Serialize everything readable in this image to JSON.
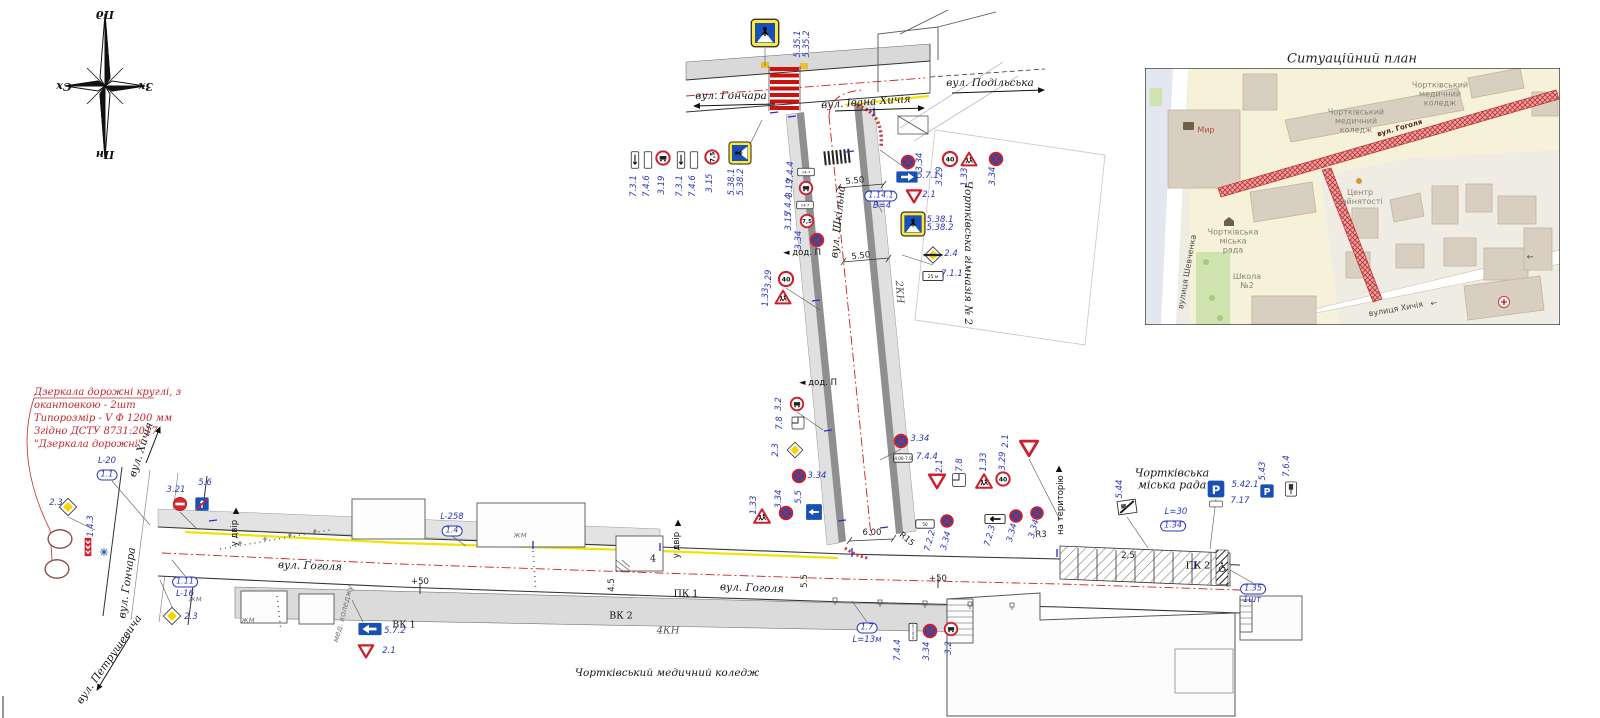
{
  "compass": {
    "top": "Пд",
    "left": "Сх",
    "right": "Зх",
    "bottom": "Пн"
  },
  "note": {
    "lines": [
      "Дзеркала дорожні круглі, з",
      "окантовкою - 2шт",
      "Типорозмір - V  Ф 1200 мм",
      "Згідно ДСТУ 8731:2017",
      "\"Дзеркала дорожні\""
    ]
  },
  "inset": {
    "title": "Ситуаційний план"
  },
  "annotations": [
    {
      "t": "Пд",
      "x": 105,
      "y": 14,
      "c": "cmp",
      "r": 180,
      "n": "compass-label-south"
    },
    {
      "t": "Сх",
      "x": 64,
      "y": 86,
      "c": "cmp",
      "r": 180,
      "n": "compass-label-east"
    },
    {
      "t": "Зх",
      "x": 146,
      "y": 86,
      "c": "cmp",
      "r": 180,
      "n": "compass-label-west"
    },
    {
      "t": "Пн",
      "x": 105,
      "y": 154,
      "c": "cmp",
      "r": 180,
      "n": "compass-label-north"
    },
    {
      "t": "вул. Гончара",
      "x": 731,
      "y": 97,
      "c": "st",
      "n": "street-honchara"
    },
    {
      "t": "вул. Івана Хичія",
      "x": 866,
      "y": 103,
      "c": "st",
      "r": -4,
      "n": "street-ivana-khychiia"
    },
    {
      "t": "вул. Подільська",
      "x": 990,
      "y": 84,
      "c": "st",
      "n": "street-podilska"
    },
    {
      "t": "вул. Шкільна",
      "x": 839,
      "y": 222,
      "c": "st",
      "r": -84,
      "n": "street-shkilna"
    },
    {
      "t": "вул. Гоголя",
      "x": 310,
      "y": 567,
      "c": "st",
      "r": 2,
      "n": "street-hoholia"
    },
    {
      "t": "вул. Гоголя",
      "x": 752,
      "y": 589,
      "c": "st",
      "r": 2,
      "n": "street-hoholia"
    },
    {
      "t": "вул. Гончара",
      "x": 128,
      "y": 583,
      "c": "st",
      "r": -82,
      "n": "street-honchara"
    },
    {
      "t": "вул. Хичія",
      "x": 142,
      "y": 450,
      "c": "st",
      "r": -72,
      "n": "street-khychiia"
    },
    {
      "t": "вул. Петрушевича",
      "x": 110,
      "y": 660,
      "c": "st",
      "r": -55,
      "n": "street-petrushevycha"
    },
    {
      "t": "Чортківська гімназія № 2",
      "x": 967,
      "y": 253,
      "c": "st",
      "r": 90,
      "n": "gymnasium-label"
    },
    {
      "t": "Чортківська\nміська рада",
      "x": 1172,
      "y": 480,
      "c": "stc",
      "n": "city-council-label"
    },
    {
      "t": "Чортківський медичний коледж",
      "x": 667,
      "y": 674,
      "c": "st",
      "n": "medical-college-label"
    },
    {
      "t": "2КН",
      "x": 899,
      "y": 292,
      "c": "stg",
      "r": 86
    },
    {
      "t": "4КН",
      "x": 668,
      "y": 631,
      "c": "stg"
    },
    {
      "t": "ВК 1",
      "x": 404,
      "y": 626,
      "c": "bk2"
    },
    {
      "t": "ВК 2",
      "x": 621,
      "y": 617,
      "c": "bk2"
    },
    {
      "t": "ПК 1",
      "x": 686,
      "y": 595,
      "c": "bk2"
    },
    {
      "t": "ПК 2",
      "x": 1198,
      "y": 567,
      "c": "bk2"
    },
    {
      "t": "+50",
      "x": 420,
      "y": 583,
      "c": "dim"
    },
    {
      "t": "+50",
      "x": 938,
      "y": 580,
      "c": "dim"
    },
    {
      "t": "6.00",
      "x": 872,
      "y": 534,
      "c": "dim"
    },
    {
      "t": "5.50",
      "x": 855,
      "y": 182,
      "c": "dim",
      "r": -6
    },
    {
      "t": "5.50",
      "x": 861,
      "y": 257,
      "c": "dim",
      "r": -6
    },
    {
      "t": "R15",
      "x": 906,
      "y": 540,
      "c": "dim",
      "r": 40
    },
    {
      "t": "R3",
      "x": 1041,
      "y": 536,
      "c": "dim"
    },
    {
      "t": "4",
      "x": 653,
      "y": 560,
      "c": "bk2"
    },
    {
      "t": "2,5",
      "x": 1128,
      "y": 557,
      "c": "dim"
    },
    {
      "t": "4.5",
      "x": 613,
      "y": 585,
      "c": "dim",
      "r": -90
    },
    {
      "t": "5.5",
      "x": 806,
      "y": 581,
      "c": "dim",
      "r": -90
    },
    {
      "t": "◄ дод. П",
      "x": 802,
      "y": 254,
      "c": "bk"
    },
    {
      "t": "◄ дод. П",
      "x": 818,
      "y": 384,
      "c": "bk"
    },
    {
      "t": "у двір",
      "x": 678,
      "y": 545,
      "c": "bk",
      "r": -90
    },
    {
      "t": "▲",
      "x": 678,
      "y": 524,
      "c": "bk"
    },
    {
      "t": "у двір",
      "x": 236,
      "y": 533,
      "c": "bk",
      "r": -90
    },
    {
      "t": "▲",
      "x": 236,
      "y": 512,
      "c": "bk"
    },
    {
      "t": "на територію",
      "x": 1062,
      "y": 505,
      "c": "bk",
      "r": -90
    },
    {
      "t": "▲",
      "x": 1059,
      "y": 470,
      "c": "bk"
    },
    {
      "t": "мед. коледжу",
      "x": 344,
      "y": 614,
      "c": "bkg",
      "r": -75
    },
    {
      "t": "жм",
      "x": 195,
      "y": 600,
      "c": "bkg"
    },
    {
      "t": "жм",
      "x": 248,
      "y": 621,
      "c": "bkg"
    },
    {
      "t": "жм",
      "x": 520,
      "y": 536,
      "c": "bkg"
    },
    {
      "t": "5.35.1",
      "x": 799,
      "y": 44,
      "c": "bl",
      "r": -90
    },
    {
      "t": "5.35.2",
      "x": 808,
      "y": 44,
      "c": "bl",
      "r": -90
    },
    {
      "t": "7.3.1",
      "x": 635,
      "y": 186,
      "c": "bl",
      "r": -90
    },
    {
      "t": "7.4.6",
      "x": 648,
      "y": 186,
      "c": "bl",
      "r": -90
    },
    {
      "t": "3.19",
      "x": 663,
      "y": 185,
      "c": "bl",
      "r": -90
    },
    {
      "t": "7.3.1",
      "x": 681,
      "y": 186,
      "c": "bl",
      "r": -90
    },
    {
      "t": "7.4.6",
      "x": 694,
      "y": 186,
      "c": "bl",
      "r": -90
    },
    {
      "t": "3.15",
      "x": 711,
      "y": 183,
      "c": "bl",
      "r": -90
    },
    {
      "t": "5.38.1",
      "x": 733,
      "y": 182,
      "c": "bl",
      "r": -90
    },
    {
      "t": "5.38.2",
      "x": 742,
      "y": 182,
      "c": "bl",
      "r": -90
    },
    {
      "t": "3.34",
      "x": 921,
      "y": 162,
      "c": "bl",
      "r": -90
    },
    {
      "t": "5.7.1",
      "x": 928,
      "y": 177,
      "c": "bl"
    },
    {
      "t": "2.1",
      "x": 929,
      "y": 196,
      "c": "bl"
    },
    {
      "t": "5.38.1",
      "x": 940,
      "y": 221,
      "c": "bl"
    },
    {
      "t": "5.38.2",
      "x": 940,
      "y": 229,
      "c": "bl"
    },
    {
      "t": "2.4",
      "x": 951,
      "y": 255,
      "c": "bl"
    },
    {
      "t": "7.1.1",
      "x": 952,
      "y": 275,
      "c": "bl"
    },
    {
      "t": "3.29",
      "x": 941,
      "y": 176,
      "c": "bl",
      "r": -90
    },
    {
      "t": "1.33",
      "x": 966,
      "y": 177,
      "c": "bl",
      "r": -90
    },
    {
      "t": "3.34",
      "x": 994,
      "y": 176,
      "c": "bl",
      "r": -90
    },
    {
      "t": "1.14.1",
      "x": 881,
      "y": 196,
      "c": "bx",
      "n": "marking-label"
    },
    {
      "t": "В=4",
      "x": 882,
      "y": 207,
      "c": "bl"
    },
    {
      "t": "7.4.4",
      "x": 792,
      "y": 172,
      "c": "bl",
      "r": -90
    },
    {
      "t": "3.19",
      "x": 791,
      "y": 188,
      "c": "bl",
      "r": -90
    },
    {
      "t": "7.4.4",
      "x": 790,
      "y": 205,
      "c": "bl",
      "r": -90
    },
    {
      "t": "3.15",
      "x": 790,
      "y": 221,
      "c": "bl",
      "r": -90
    },
    {
      "t": "3.34",
      "x": 800,
      "y": 240,
      "c": "bl",
      "r": -90
    },
    {
      "t": "3.29",
      "x": 770,
      "y": 279,
      "c": "bl",
      "r": -90
    },
    {
      "t": "1.33",
      "x": 767,
      "y": 297,
      "c": "bl",
      "r": -90
    },
    {
      "t": "3.2",
      "x": 780,
      "y": 404,
      "c": "bl",
      "r": -90
    },
    {
      "t": "7.8",
      "x": 781,
      "y": 423,
      "c": "bl",
      "r": -90
    },
    {
      "t": "2.3",
      "x": 777,
      "y": 450,
      "c": "bl",
      "r": -90
    },
    {
      "t": "3.34",
      "x": 817,
      "y": 477,
      "c": "bl"
    },
    {
      "t": "5.5",
      "x": 800,
      "y": 497,
      "c": "bl",
      "r": -90
    },
    {
      "t": "1.33",
      "x": 755,
      "y": 505,
      "c": "bl",
      "r": -90
    },
    {
      "t": "3.34",
      "x": 780,
      "y": 499,
      "c": "bl",
      "r": -90
    },
    {
      "t": "3.34",
      "x": 920,
      "y": 440,
      "c": "bl"
    },
    {
      "t": "7.4.4",
      "x": 927,
      "y": 458,
      "c": "bl"
    },
    {
      "t": "2.1",
      "x": 941,
      "y": 466,
      "c": "bl",
      "r": -90
    },
    {
      "t": "7.8",
      "x": 961,
      "y": 465,
      "c": "bl",
      "r": -90
    },
    {
      "t": "1.33",
      "x": 985,
      "y": 462,
      "c": "bl",
      "r": -90
    },
    {
      "t": "3.29",
      "x": 1004,
      "y": 461,
      "c": "bl",
      "r": -90
    },
    {
      "t": "2.1",
      "x": 1007,
      "y": 441,
      "c": "bl",
      "r": -90
    },
    {
      "t": "7.2.2",
      "x": 931,
      "y": 541,
      "c": "bl",
      "r": -75
    },
    {
      "t": "3.34",
      "x": 947,
      "y": 541,
      "c": "bl",
      "r": -75
    },
    {
      "t": "7.2.3",
      "x": 991,
      "y": 536,
      "c": "bl",
      "r": -75
    },
    {
      "t": "3.34",
      "x": 1013,
      "y": 533,
      "c": "bl",
      "r": -75
    },
    {
      "t": "3.34",
      "x": 1035,
      "y": 529,
      "c": "bl",
      "r": -75
    },
    {
      "t": "5.44",
      "x": 1121,
      "y": 489,
      "c": "bl",
      "r": -90
    },
    {
      "t": "5.42.1",
      "x": 1245,
      "y": 486,
      "c": "bl"
    },
    {
      "t": "7.17",
      "x": 1240,
      "y": 502,
      "c": "bl"
    },
    {
      "t": "5.43",
      "x": 1264,
      "y": 471,
      "c": "bl",
      "r": -90
    },
    {
      "t": "7.6.4",
      "x": 1288,
      "y": 466,
      "c": "bl",
      "r": -90
    },
    {
      "t": "L=30",
      "x": 1176,
      "y": 513,
      "c": "bl"
    },
    {
      "t": "1.34",
      "x": 1173,
      "y": 526,
      "c": "bx"
    },
    {
      "t": "1.35",
      "x": 1253,
      "y": 589,
      "c": "bx"
    },
    {
      "t": "1шт",
      "x": 1252,
      "y": 601,
      "c": "bl"
    },
    {
      "t": "1.7",
      "x": 867,
      "y": 628,
      "c": "bx"
    },
    {
      "t": "L=13м",
      "x": 867,
      "y": 641,
      "c": "bl"
    },
    {
      "t": "7.4.4",
      "x": 899,
      "y": 650,
      "c": "bl",
      "r": -90
    },
    {
      "t": "3.34",
      "x": 928,
      "y": 651,
      "c": "bl",
      "r": -90
    },
    {
      "t": "3.2",
      "x": 950,
      "y": 648,
      "c": "bl",
      "r": -90
    },
    {
      "t": "5.7.2",
      "x": 395,
      "y": 632,
      "c": "bl"
    },
    {
      "t": "2.1",
      "x": 389,
      "y": 652,
      "c": "bl"
    },
    {
      "t": "L-258",
      "x": 452,
      "y": 518,
      "c": "bl"
    },
    {
      "t": "1.4",
      "x": 452,
      "y": 531,
      "c": "bx"
    },
    {
      "t": "L-20",
      "x": 107,
      "y": 462,
      "c": "bl"
    },
    {
      "t": "1.1",
      "x": 107,
      "y": 475,
      "c": "bx"
    },
    {
      "t": "1.11",
      "x": 185,
      "y": 582,
      "c": "bx"
    },
    {
      "t": "L-16",
      "x": 185,
      "y": 595,
      "c": "bl"
    },
    {
      "t": "3.21",
      "x": 176,
      "y": 491,
      "c": "bl"
    },
    {
      "t": "5.6",
      "x": 205,
      "y": 484,
      "c": "bl"
    },
    {
      "t": "2.3",
      "x": 56,
      "y": 504,
      "c": "bl"
    },
    {
      "t": "1.4.3",
      "x": 92,
      "y": 526,
      "c": "bl",
      "r": -90
    },
    {
      "t": "2.3",
      "x": 191,
      "y": 618,
      "c": "bl"
    },
    {
      "t": "Мир",
      "x": 1206,
      "y": 131,
      "c": "mpr",
      "n": "map-label-myr"
    },
    {
      "t": "Чортківський\nмедичний\nколедж",
      "x": 1440,
      "y": 95,
      "c": "mp ann",
      "n": "map-label-college"
    },
    {
      "t": "Чортківський\nмедичний\nколедж",
      "x": 1356,
      "y": 122,
      "c": "mp",
      "n": "map-label-college"
    },
    {
      "t": "Центр\nзайнятості",
      "x": 1360,
      "y": 198,
      "c": "mp",
      "n": "map-label-employment-center"
    },
    {
      "t": "Чортківська\nміська\nрада",
      "x": 1233,
      "y": 242,
      "c": "mp",
      "n": "map-label-city-council"
    },
    {
      "t": "Школа\n№2",
      "x": 1247,
      "y": 282,
      "c": "mp",
      "n": "map-label-school"
    },
    {
      "t": "вулиця Шевченка",
      "x": 1188,
      "y": 272,
      "c": "mpk",
      "r": -80,
      "n": "map-street-shevchenka"
    },
    {
      "t": "вулиця Хичія",
      "x": 1396,
      "y": 310,
      "c": "mpk",
      "r": -10,
      "n": "map-street-khychiia"
    },
    {
      "t": "←",
      "x": 1434,
      "y": 304,
      "c": "mpk",
      "r": -10
    },
    {
      "t": "←",
      "x": 1530,
      "y": 258,
      "c": "mpk"
    },
    {
      "t": "вул. Гоголя",
      "x": 1400,
      "y": 129,
      "c": "rt",
      "r": -16,
      "n": "map-street-hoholia"
    }
  ],
  "signs": [
    {
      "t": "ped",
      "c": "5.35",
      "x": 765,
      "y": 33,
      "s": 30
    },
    {
      "t": "plate_tall_arrow",
      "c": "7.3.1",
      "x": 635,
      "y": 160,
      "s": 18
    },
    {
      "t": "plate_tall",
      "c": "7.4.6",
      "x": 648,
      "y": 160,
      "s": 18
    },
    {
      "t": "ring_glyph",
      "c": "3.19",
      "x": 663,
      "y": 158,
      "s": 16
    },
    {
      "t": "plate_tall_arrow",
      "c": "7.3.1",
      "x": 681,
      "y": 160,
      "s": 18
    },
    {
      "t": "plate_tall",
      "c": "7.4.6",
      "x": 694,
      "y": 160,
      "s": 18
    },
    {
      "t": "ring_txt",
      "c": "3.15",
      "x": 712,
      "y": 157,
      "s": 16,
      "text": "7,5",
      "r": -90
    },
    {
      "t": "ped",
      "c": "5.38",
      "x": 740,
      "y": 153,
      "s": 24,
      "r": -90
    },
    {
      "t": "nostop",
      "c": "3.34",
      "x": 908,
      "y": 162,
      "s": 15
    },
    {
      "t": "b_arrow",
      "c": "5.7.1",
      "dir": "right",
      "x": 907,
      "y": 177,
      "s": 24
    },
    {
      "t": "yield",
      "c": "2.1",
      "x": 914,
      "y": 196,
      "s": 18
    },
    {
      "t": "ped",
      "c": "5.38",
      "x": 913,
      "y": 224,
      "s": 26
    },
    {
      "t": "prio_end",
      "c": "2.4",
      "x": 933,
      "y": 255,
      "s": 20
    },
    {
      "t": "plate",
      "c": "7.1.1",
      "x": 933,
      "y": 276,
      "s": 22,
      "text": "25 м"
    },
    {
      "t": "ring_txt",
      "c": "3.29",
      "x": 950,
      "y": 159,
      "s": 17,
      "text": "40"
    },
    {
      "t": "children",
      "c": "1.33",
      "x": 969,
      "y": 159,
      "s": 18
    },
    {
      "t": "nostop",
      "c": "3.34",
      "x": 996,
      "y": 159,
      "s": 15
    },
    {
      "t": "plate",
      "c": "7.4.4",
      "x": 806,
      "y": 172,
      "s": 18,
      "text": "14-7"
    },
    {
      "t": "ring_glyph",
      "c": "3.19",
      "x": 806,
      "y": 188,
      "s": 15
    },
    {
      "t": "plate",
      "c": "7.4.4",
      "x": 805,
      "y": 205,
      "s": 18,
      "text": "14-7"
    },
    {
      "t": "ring_txt",
      "c": "3.15",
      "x": 807,
      "y": 221,
      "s": 15,
      "text": "7,5"
    },
    {
      "t": "nostop",
      "c": "3.34",
      "x": 817,
      "y": 240,
      "s": 15
    },
    {
      "t": "ring_txt",
      "c": "3.29",
      "x": 786,
      "y": 279,
      "s": 17,
      "text": "40"
    },
    {
      "t": "children",
      "c": "1.33",
      "x": 783,
      "y": 297,
      "s": 18
    },
    {
      "t": "ring_glyph",
      "c": "3.2",
      "x": 797,
      "y": 404,
      "s": 15
    },
    {
      "t": "plate78",
      "c": "7.8",
      "x": 798,
      "y": 423,
      "s": 16
    },
    {
      "t": "prio",
      "c": "2.3",
      "x": 795,
      "y": 450,
      "s": 19
    },
    {
      "t": "nostop",
      "c": "3.34",
      "x": 799,
      "y": 476,
      "s": 15
    },
    {
      "t": "children",
      "c": "1.33",
      "x": 762,
      "y": 516,
      "s": 19
    },
    {
      "t": "nostop",
      "c": "3.34",
      "x": 786,
      "y": 513,
      "s": 15
    },
    {
      "t": "b_sq_arrow",
      "c": "5.5",
      "dir": "left",
      "x": 814,
      "y": 512,
      "s": 19
    },
    {
      "t": "nostop",
      "c": "3.34",
      "x": 901,
      "y": 441,
      "s": 15
    },
    {
      "t": "plate",
      "c": "7.4.4",
      "x": 903,
      "y": 458,
      "s": 20,
      "text": "14.00-7.00"
    },
    {
      "t": "yield",
      "c": "2.1",
      "x": 937,
      "y": 481,
      "s": 20
    },
    {
      "t": "plate78",
      "c": "7.8",
      "x": 959,
      "y": 480,
      "s": 17
    },
    {
      "t": "children",
      "c": "1.33",
      "x": 984,
      "y": 481,
      "s": 19
    },
    {
      "t": "ring_txt",
      "c": "3.29",
      "x": 1003,
      "y": 479,
      "s": 16,
      "text": "40"
    },
    {
      "t": "yield",
      "c": "2.1",
      "x": 1029,
      "y": 448,
      "s": 22
    },
    {
      "t": "plate",
      "c": "7.2.2",
      "x": 925,
      "y": 524,
      "s": 20,
      "text": "50"
    },
    {
      "t": "nostop",
      "c": "3.34",
      "x": 947,
      "y": 521,
      "s": 14
    },
    {
      "t": "plate_arrow",
      "c": "7.2.3",
      "dir": "left",
      "x": 995,
      "y": 519,
      "s": 22
    },
    {
      "t": "nostop",
      "c": "3.34",
      "x": 1016,
      "y": 516,
      "s": 14
    },
    {
      "t": "nostop",
      "c": "3.34",
      "x": 1037,
      "y": 513,
      "s": 14
    },
    {
      "t": "s544",
      "c": "5.44",
      "x": 1127,
      "y": 507,
      "s": 20,
      "r": -8
    },
    {
      "t": "P",
      "c": "5.42.1",
      "x": 1216,
      "y": 489,
      "s": 20,
      "text": "P"
    },
    {
      "t": "plate",
      "c": "7.17",
      "x": 1216,
      "y": 504,
      "s": 14,
      "text": ""
    },
    {
      "t": "P",
      "c": "5.43",
      "x": 1267,
      "y": 491,
      "s": 16,
      "text": "P"
    },
    {
      "t": "meterplate",
      "c": "7.6.4",
      "x": 1291,
      "y": 489,
      "s": 17
    },
    {
      "t": "wheelchair",
      "c": "disabled-parking",
      "x": 1223,
      "y": 567,
      "s": 12
    },
    {
      "t": "plate_tall",
      "c": "7.4.4",
      "x": 913,
      "y": 632,
      "s": 19,
      "text": "14.00-7.00"
    },
    {
      "t": "nostop",
      "c": "3.34",
      "x": 930,
      "y": 631,
      "s": 15
    },
    {
      "t": "ring_glyph",
      "c": "3.2",
      "x": 951,
      "y": 629,
      "s": 15
    },
    {
      "t": "b_arrow",
      "c": "5.7.2",
      "dir": "left",
      "x": 370,
      "y": 629,
      "s": 26
    },
    {
      "t": "yield",
      "c": "2.1",
      "x": 366,
      "y": 651,
      "s": 18
    },
    {
      "t": "prio",
      "c": "2.3",
      "x": 68,
      "y": 507,
      "s": 21
    },
    {
      "t": "mirror",
      "c": "road-mirror",
      "x": 60,
      "y": 539,
      "s": 26
    },
    {
      "t": "mirror",
      "c": "road-mirror",
      "x": 57,
      "y": 569,
      "s": 26
    },
    {
      "t": "chev",
      "c": "1.4.3",
      "x": 88,
      "y": 547,
      "s": 20
    },
    {
      "t": "bluecross",
      "c": "drain-marker",
      "x": 104,
      "y": 552,
      "s": 12
    },
    {
      "t": "noentry",
      "c": "3.21",
      "x": 180,
      "y": 504,
      "s": 16
    },
    {
      "t": "oneway_end",
      "c": "5.6",
      "x": 202,
      "y": 504,
      "s": 16
    },
    {
      "t": "prio",
      "c": "2.3",
      "x": 172,
      "y": 616,
      "s": 21
    }
  ]
}
